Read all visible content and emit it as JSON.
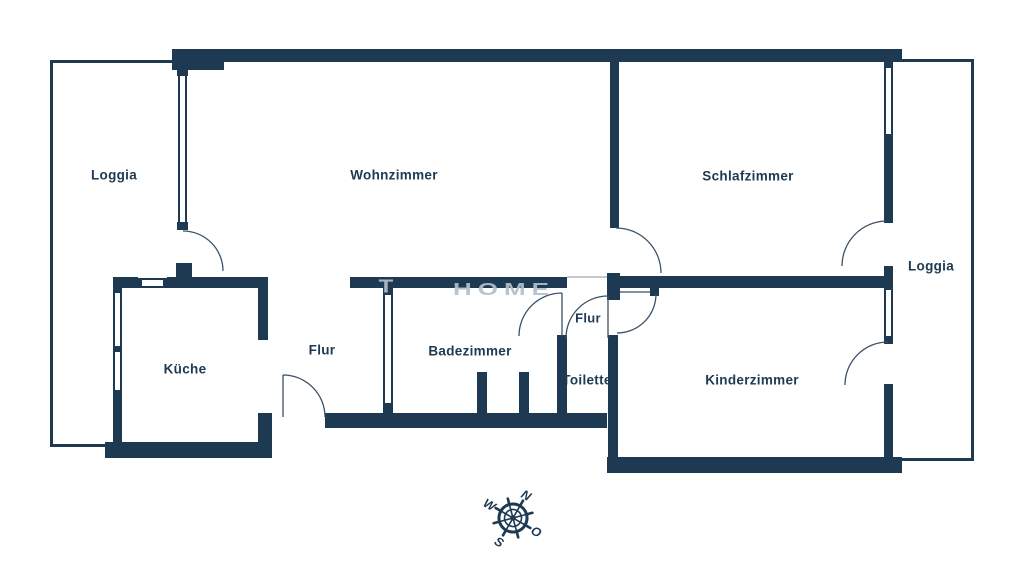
{
  "floorplan": {
    "rooms": {
      "loggia_left": "Loggia",
      "wohnzimmer": "Wohnzimmer",
      "schlafzimmer": "Schlafzimmer",
      "loggia_right": "Loggia",
      "kueche": "Küche",
      "flur_main": "Flur",
      "badezimmer": "Badezimmer",
      "flur_small": "Flur",
      "toilette": "Toilette",
      "kinderzimmer": "Kinderzimmer"
    },
    "compass": {
      "n": "N",
      "o": "O",
      "s": "S",
      "w": "W"
    },
    "watermark": {
      "mark": "T",
      "text": "HOME"
    },
    "colors": {
      "wall": "#1e3a52",
      "label": "#1e3a52",
      "door_arc": "#3c5266",
      "watermark": "#b2bfcb"
    }
  }
}
